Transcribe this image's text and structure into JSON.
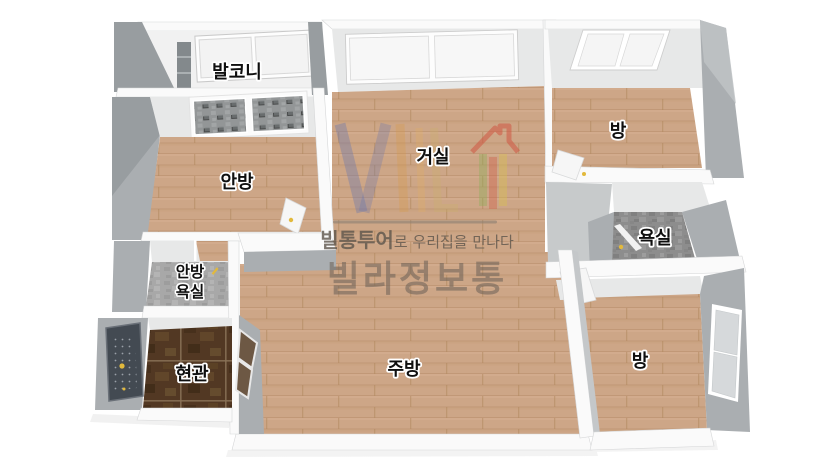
{
  "floorplan": {
    "rooms": {
      "balcony": "발코니",
      "master_bedroom": "안방",
      "living_room": "거실",
      "room_top": "방",
      "bathroom": "욕실",
      "master_bath_line1": "안방",
      "master_bath_line2": "욕실",
      "entrance": "현관",
      "kitchen": "주방",
      "room_bottom": "방"
    },
    "watermark": {
      "tagline_bold": "빌통투어",
      "tagline_rest": "로 우리집을 만나다",
      "brand": "빌라정보통"
    },
    "colors": {
      "wood_floor": "#cda687",
      "bathroom_tile": "#8d8d8d",
      "master_bath_tile": "#a8a8a8",
      "entrance_tile": "#523823",
      "balcony_floor": "#f1f1f1",
      "wall_top": "#fafafa",
      "wall_face": "#e7e8e8",
      "wall_side": "#aaaeb1",
      "entrance_door": "#434a52",
      "handle_yellow": "#e2b93c",
      "logo_blue": "#6b77ae",
      "logo_orange": "#d79a4a",
      "logo_red": "#d05642",
      "logo_green": "#8fae5a",
      "tagline_text": "#5d554c",
      "brand_text": "#6b6157"
    }
  }
}
